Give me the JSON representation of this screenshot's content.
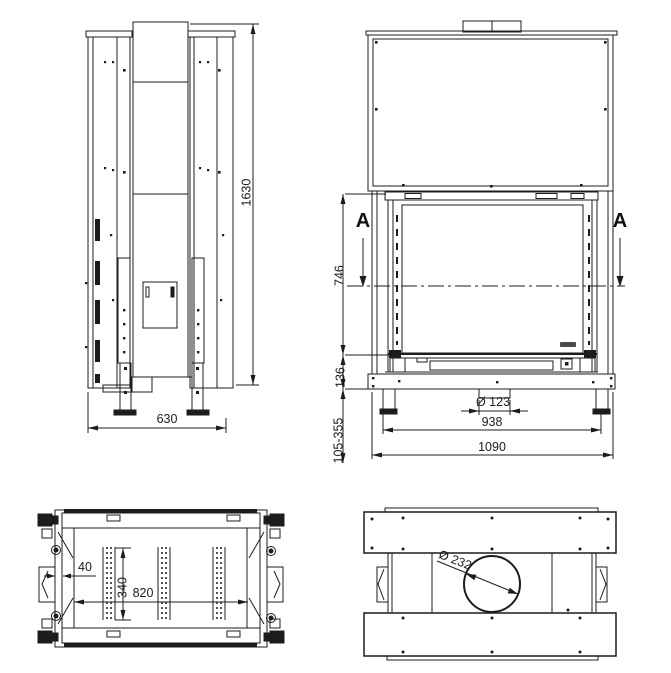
{
  "drawing_title": "fireplace installation drawing, four orthographic views",
  "colors": {
    "background": "#ffffff",
    "line": "#1c1c1c"
  },
  "views": {
    "side": {
      "dim_height": "1630",
      "dim_depth": "630"
    },
    "front": {
      "section_marker": "A",
      "dim_opening_height": "746",
      "dim_base_height": "136",
      "dim_leg_height_range": "105-355",
      "dim_air_inlet": "Ø 123",
      "dim_feet_span": "938",
      "dim_total_width": "1090"
    },
    "top": {
      "dim_frame_thickness": "40",
      "dim_inner_depth": "340",
      "dim_inner_width": "820"
    },
    "section": {
      "dim_flue_diameter": "Ø 232"
    }
  }
}
